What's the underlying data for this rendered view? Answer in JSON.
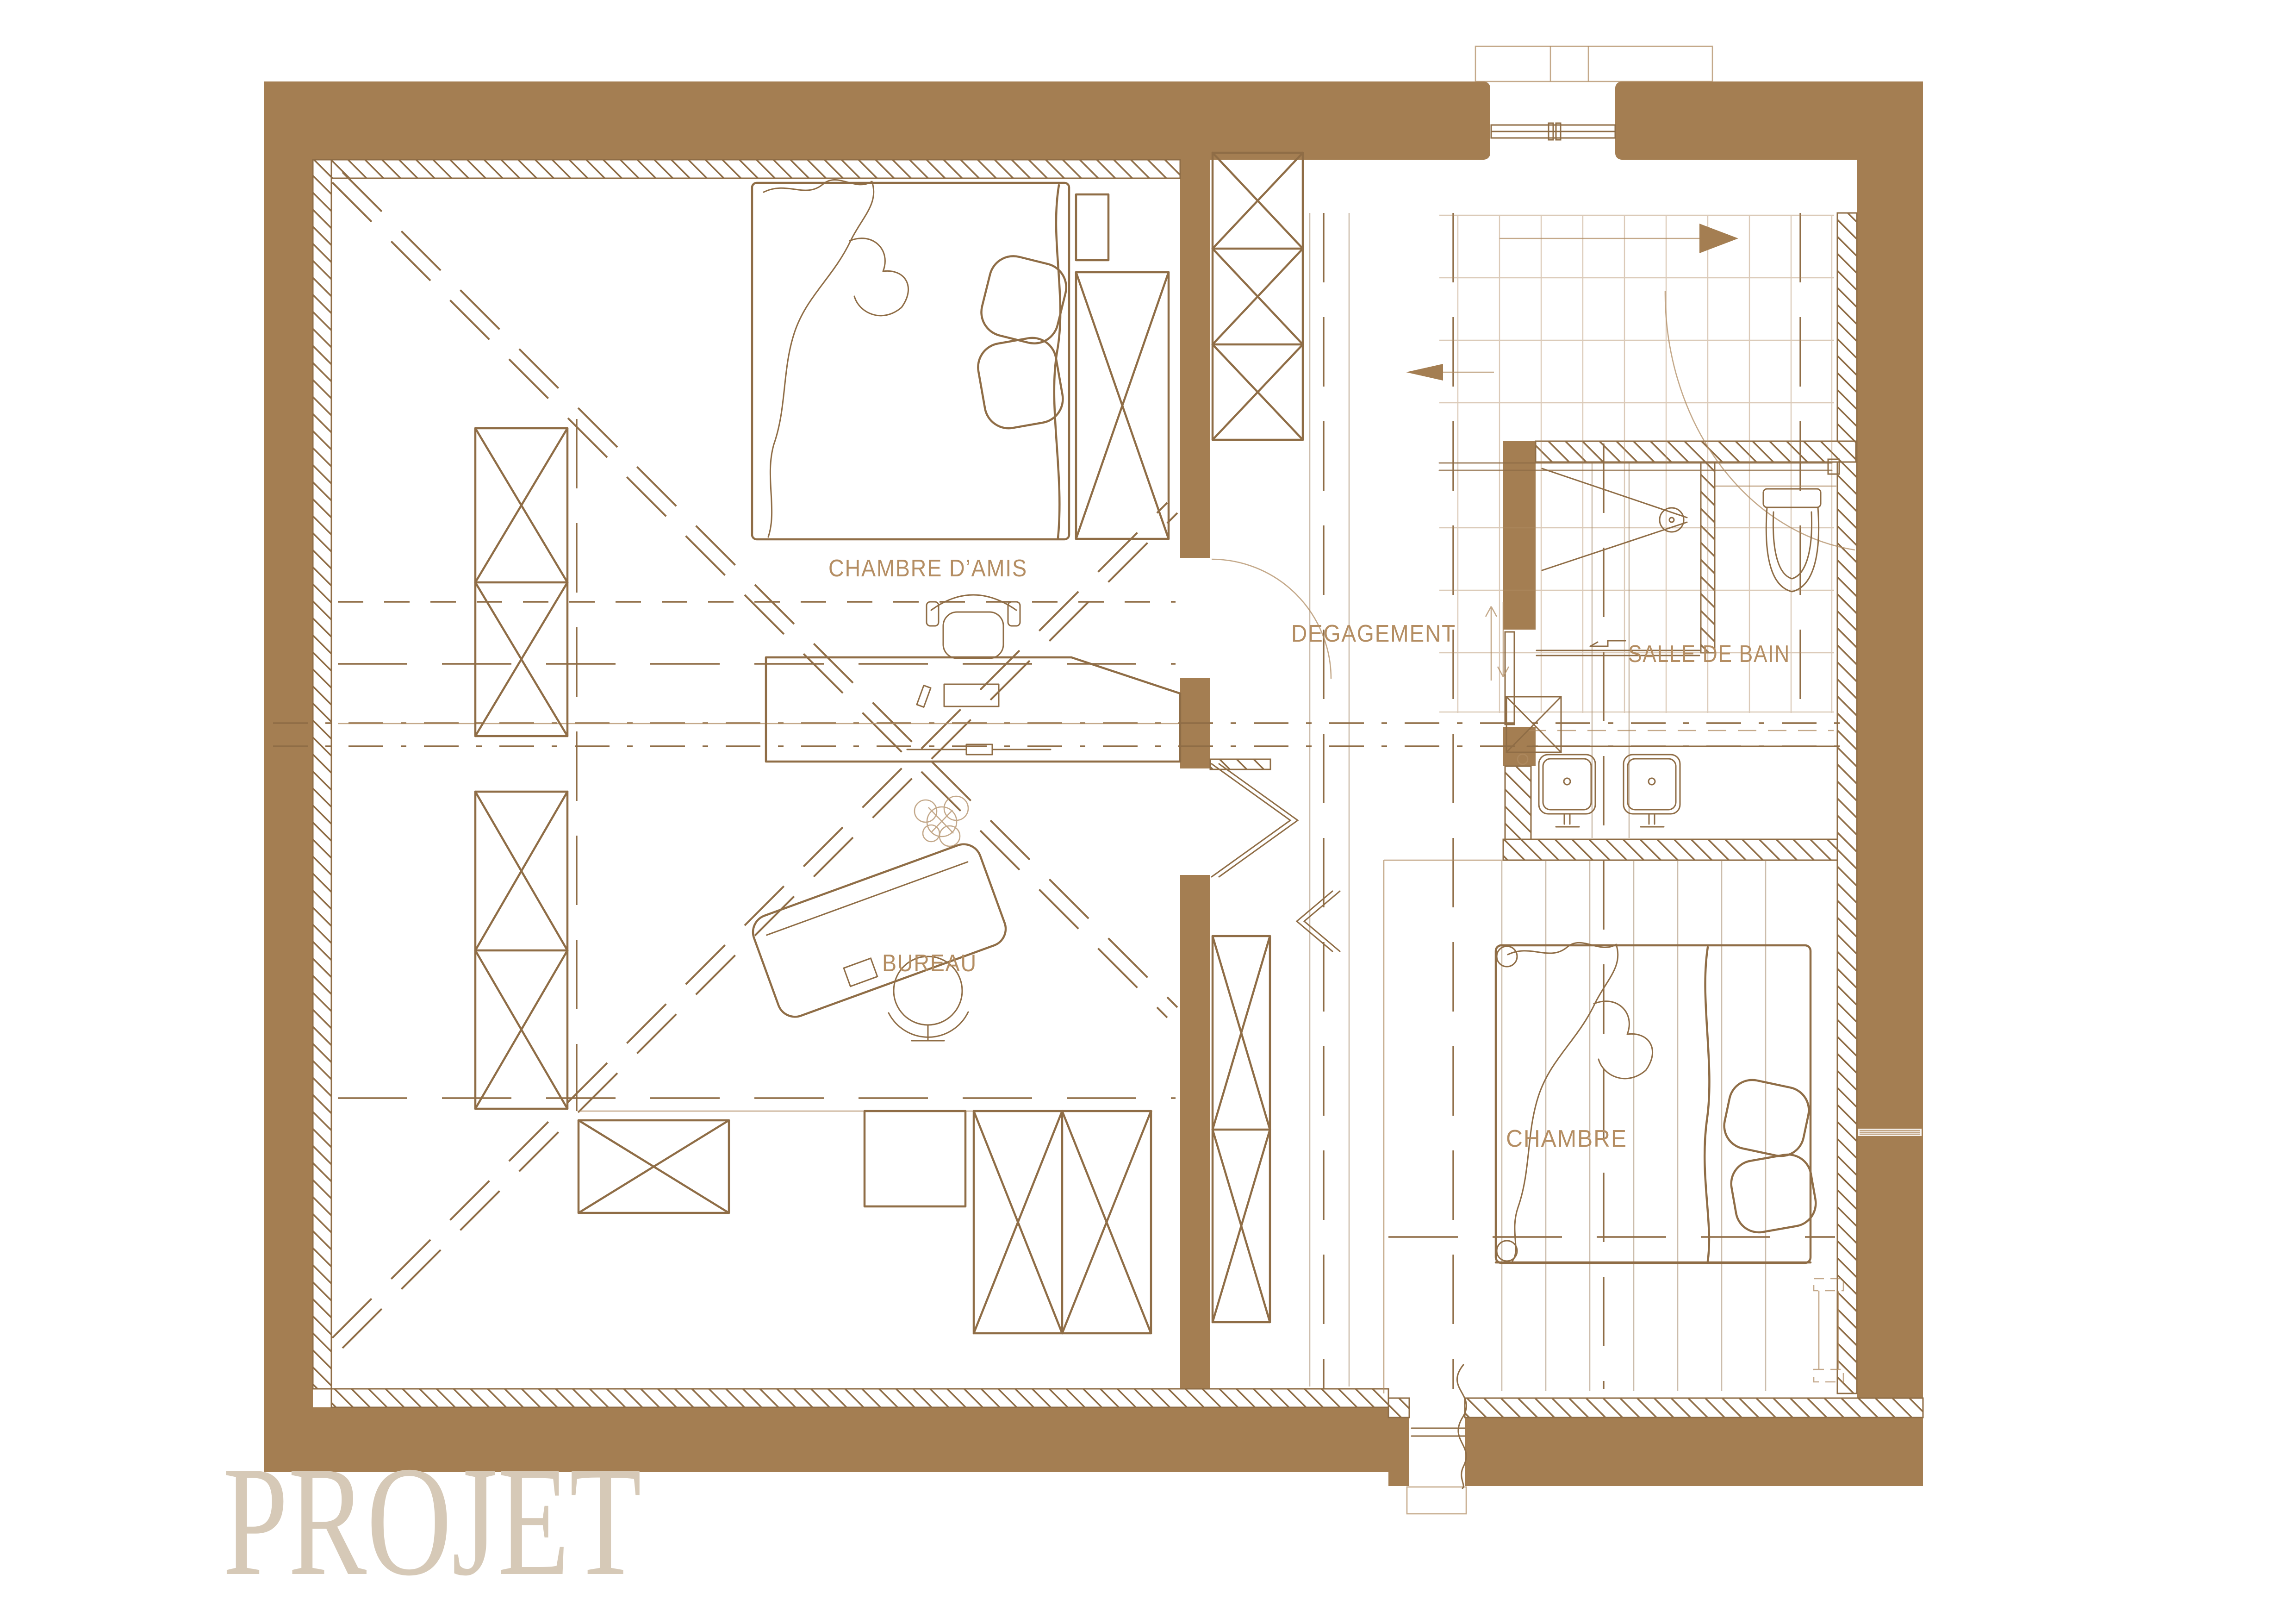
{
  "title": {
    "text": "PROJET"
  },
  "rooms": [
    {
      "id": "chambre-damis",
      "label": "CHAMBRE D’AMIS"
    },
    {
      "id": "degagement",
      "label": "DEGAGEMENT"
    },
    {
      "id": "salle-de-bain",
      "label": "SALLE DE BAIN"
    },
    {
      "id": "bureau",
      "label": "BUREAU"
    },
    {
      "id": "chambre",
      "label": "CHAMBRE"
    }
  ],
  "palette": {
    "wall": "#A47E52",
    "line": "#8F6D46",
    "line_light": "#B08C63",
    "label_text": "#B48D62",
    "title_text": "#D6C9B7",
    "background": "#FFFFFF"
  },
  "plan": {
    "type": "architectural-floor-plan",
    "drawing_phase": "PROJET",
    "stair_arrows": [
      "right",
      "left",
      "up",
      "down"
    ]
  }
}
